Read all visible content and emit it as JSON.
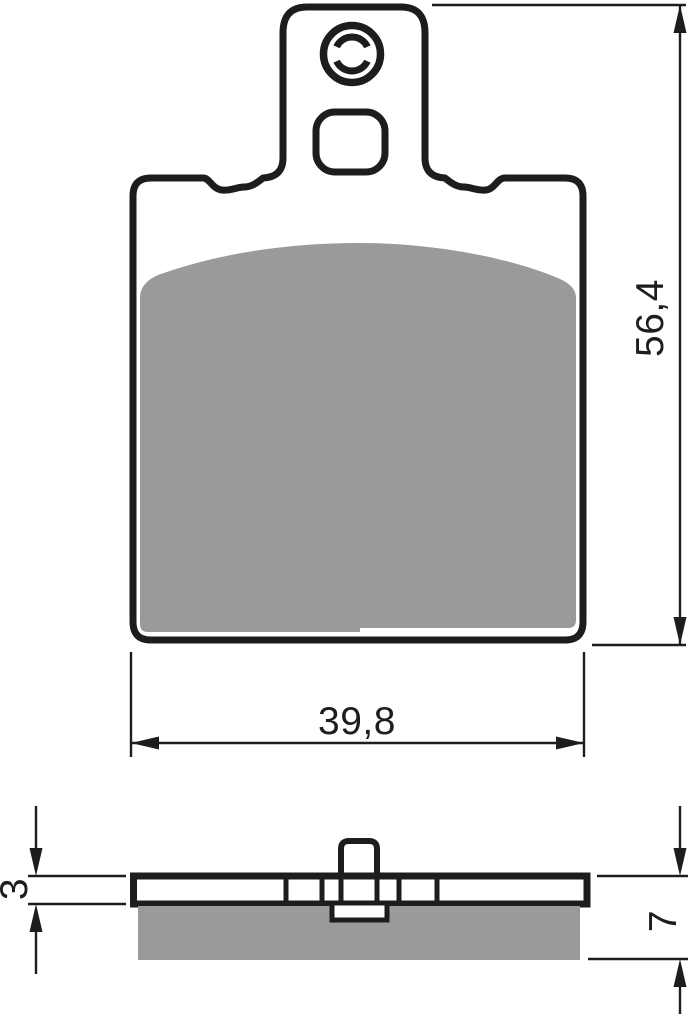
{
  "drawing": {
    "colors": {
      "outline": "#1d1d1b",
      "friction_material": "#9a9a99",
      "background": "#ffffff"
    },
    "labels": {
      "front_height": "56,4",
      "front_width": "39,8",
      "side_plate_thickness": "3",
      "side_total_thickness": "7"
    }
  }
}
